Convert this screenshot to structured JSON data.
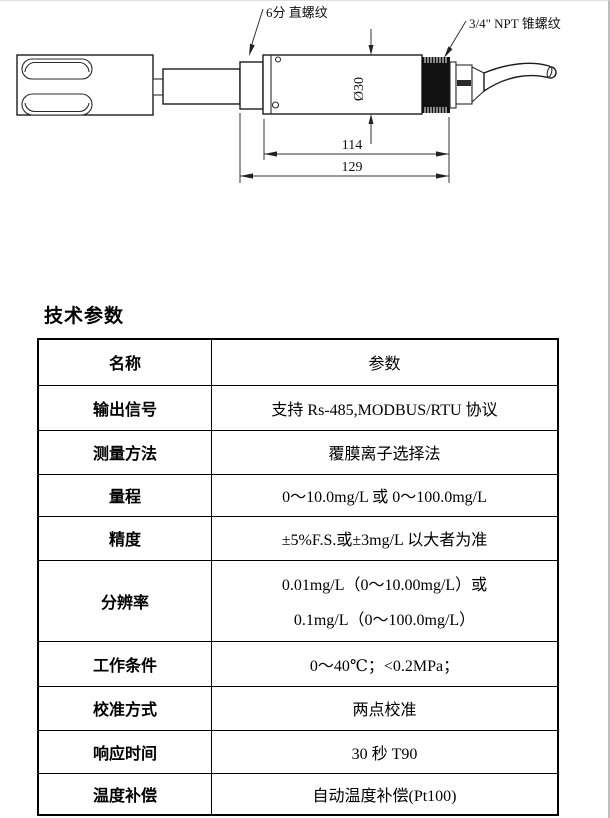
{
  "document": {
    "section_title": "技术参数"
  },
  "diagram": {
    "label_straight_thread": "6分 直螺纹",
    "label_npt_thread": "3/4\" NPT 锥螺纹",
    "dim_diameter": "Ø30",
    "dim_length_body": "114",
    "dim_length_total": "129"
  },
  "table": {
    "header": {
      "name": "名称",
      "param": "参数"
    },
    "rows": [
      {
        "name": "输出信号",
        "value": "支持 Rs-485,MODBUS/RTU 协议"
      },
      {
        "name": "测量方法",
        "value": "覆膜离子选择法"
      },
      {
        "name": "量程",
        "value": "0～10.0mg/L 或 0～100.0mg/L"
      },
      {
        "name": "精度",
        "value": "±5%F.S.或±3mg/L 以大者为准"
      },
      {
        "name": "分辨率",
        "value_line1": "0.01mg/L（0～10.00mg/L）或",
        "value_line2": "0.1mg/L（0～100.0mg/L）"
      },
      {
        "name": "工作条件",
        "value": "0～40℃；<0.2MPa；"
      },
      {
        "name": "校准方式",
        "value": "两点校准"
      },
      {
        "name": "响应时间",
        "value": "30 秒 T90"
      },
      {
        "name": "温度补偿",
        "value": "自动温度补偿(Pt100)"
      }
    ]
  }
}
